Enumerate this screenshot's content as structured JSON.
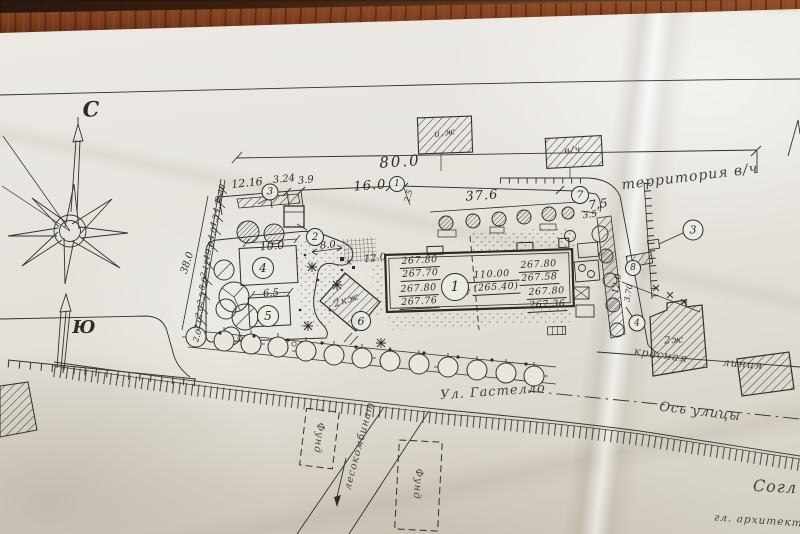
{
  "compass": {
    "north": "С",
    "south": "Ю"
  },
  "dims": {
    "total": "80.0",
    "seg_12_16": "12.16",
    "seg_3_24": "3.24",
    "seg_3_9": "3.9",
    "seg_16": "16.0",
    "seg_37_6": "37.6",
    "seg_7_5": "7,5",
    "seg_3_5": "3.5",
    "vert_2_5": "2.5",
    "left_38": "38.0",
    "left_chain": [
      "2.48",
      "4.3",
      "4.5",
      "4.0",
      "19.0",
      "2.12",
      "8.0",
      "2.5",
      "2.0",
      "2.0",
      "2.0"
    ],
    "sq4": "10.0",
    "sq5": "6.5",
    "yard_8": "8.0",
    "yard_12": "12.0",
    "fence_12": "12.0",
    "fence_3_70": "3.70"
  },
  "markers": {
    "main": "1",
    "dim": "1",
    "m2": "2",
    "m3a": "3",
    "m3b": "3",
    "m4a": "4",
    "m4b": "4",
    "m5": "5",
    "m6": "6",
    "m7": "7",
    "m8": "8"
  },
  "building": {
    "tl_top": "267.80",
    "tl_bot": "267.70",
    "bl_top": "267.80",
    "bl_bot": "267.76",
    "tr_top": "267.80",
    "tr_bot": "267.58",
    "br_top": "267.80",
    "br_bot": "267.36",
    "lvl_top": "110.00",
    "lvl_mark": "▽",
    "lvl_bot": "(265.40)"
  },
  "labels": {
    "territory": "территория в/ч",
    "hatch_a": "и.ж",
    "hatch_b": "в/ч",
    "bldg_2kzh": "2кж",
    "bldg_2zh": "2ж",
    "street": "Ул. Гастелло",
    "street_axis": "Ось улицы",
    "red_line_1": "красная",
    "red_line_2": "линия",
    "k_mark": "к",
    "fund_1": "Фунд",
    "fund_2": "Фунд",
    "road_side": "лесокомбинат",
    "sign_1": "Согл",
    "sign_2": "гл. архитекто"
  }
}
